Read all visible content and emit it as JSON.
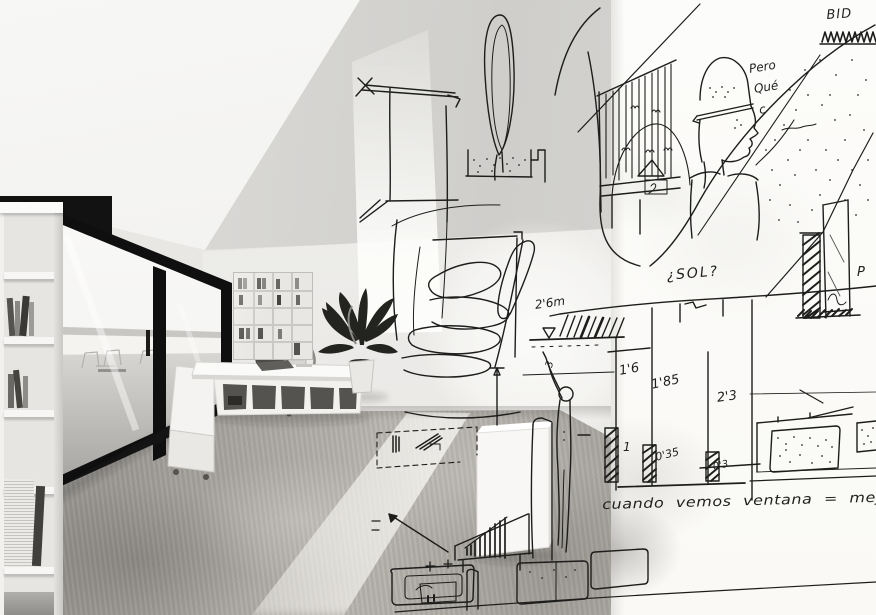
{
  "annotations": {
    "bid": "BID",
    "pero_line1": "Pero",
    "pero_line2": "Qué",
    "pero_line3": "c",
    "sol": "¿SOL?",
    "level": "2'6m",
    "dim_a": "1'6",
    "dim_b": "1'85",
    "dim_c": "2'3",
    "dim_d": "1",
    "dim_e": "0'35",
    "dim_f": "0'3",
    "dim_g": "3",
    "letter_p": "P",
    "note": "cuando vemos ventana = mejor"
  },
  "colors": {
    "ink": "#1d1d1b",
    "paper": "#fcfcfa",
    "frame_black": "#0f0f0f",
    "floor_grey": "#a5a29d"
  }
}
